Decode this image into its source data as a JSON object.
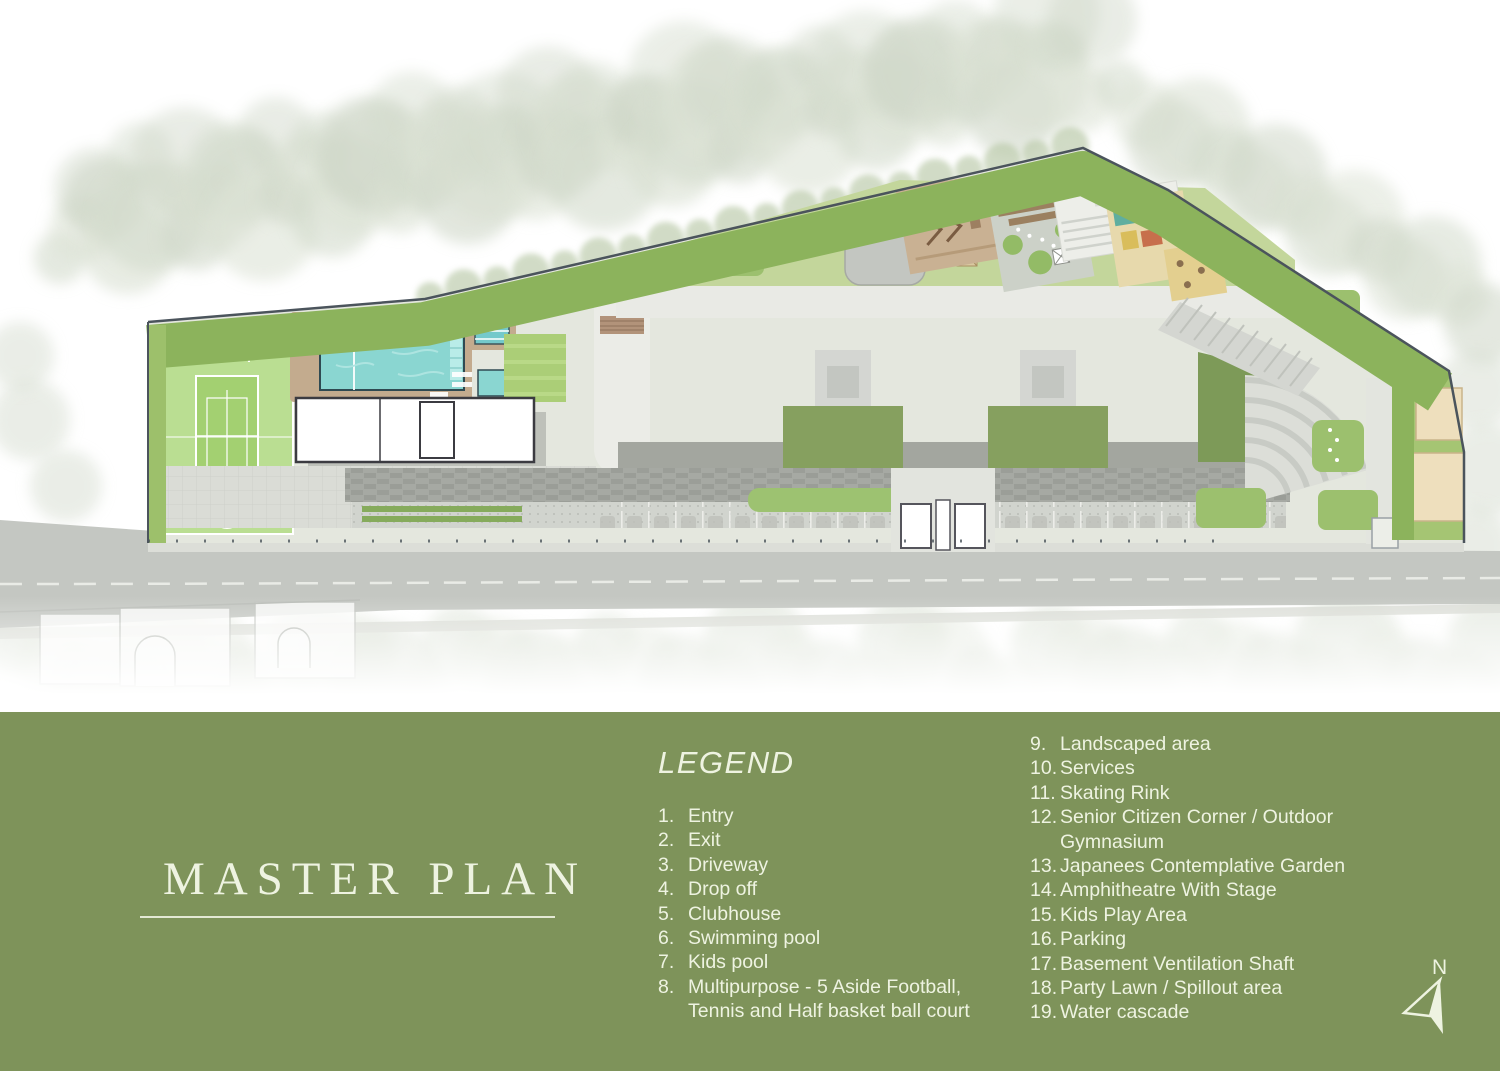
{
  "colors": {
    "band_bg": "#7E935A",
    "band_text": "#EEF3E1",
    "marker_red": "#8E1F2F",
    "tower_text": "#24242C",
    "tower_subtext": "#8B9096",
    "road_label_grey": "#C3C8C2",
    "pool_water": "#8AD6D1",
    "court_green": "#BADE92",
    "boundary_line": "#4B545C"
  },
  "plan": {
    "road_label": "ROAD",
    "towers": [
      {
        "name": "Tower - 01",
        "floors": "2B+G+17 Floors",
        "x": 741,
        "y": 352
      },
      {
        "name": "Tower - 02",
        "floors": "2B+G+11 Floors",
        "x": 946,
        "y": 352
      },
      {
        "name": "Tower - 03",
        "floors": "2B+G+17 Floors",
        "x": 1150,
        "y": 352
      }
    ],
    "markers": [
      {
        "label": "08",
        "x": 222,
        "y": 437
      },
      {
        "label": "07",
        "x": 338,
        "y": 361
      },
      {
        "label": "06",
        "x": 404,
        "y": 361
      },
      {
        "label": "19",
        "x": 493,
        "y": 329
      },
      {
        "label": "18",
        "x": 536,
        "y": 361
      },
      {
        "label": "17",
        "x": 578,
        "y": 361
      },
      {
        "label": "05",
        "x": 483,
        "y": 432
      },
      {
        "label": "09",
        "x": 738,
        "y": 256
      },
      {
        "label": "17",
        "x": 817,
        "y": 259
      },
      {
        "label": "11",
        "x": 882,
        "y": 252
      },
      {
        "label": "12",
        "x": 940,
        "y": 216
      },
      {
        "label": "13",
        "x": 1035,
        "y": 231
      },
      {
        "label": "14",
        "x": 1102,
        "y": 208
      },
      {
        "label": "15",
        "x": 1138,
        "y": 228
      },
      {
        "label": "17",
        "x": 1100,
        "y": 257
      },
      {
        "label": "09",
        "x": 1327,
        "y": 310
      },
      {
        "label": "09",
        "x": 1352,
        "y": 403
      },
      {
        "label": "10",
        "x": 1436,
        "y": 414
      },
      {
        "label": "10",
        "x": 1437,
        "y": 494
      },
      {
        "label": "04",
        "x": 742,
        "y": 484
      },
      {
        "label": "03",
        "x": 851,
        "y": 484
      },
      {
        "label": "04",
        "x": 947,
        "y": 484
      },
      {
        "label": "04",
        "x": 1147,
        "y": 483
      },
      {
        "label": "16",
        "x": 661,
        "y": 516
      },
      {
        "label": "16",
        "x": 1063,
        "y": 515
      },
      {
        "label": "09",
        "x": 1222,
        "y": 524
      },
      {
        "label": "09",
        "x": 1352,
        "y": 522
      },
      {
        "label": "01",
        "x": 918,
        "y": 551
      },
      {
        "label": "02",
        "x": 968,
        "y": 551
      },
      {
        "label": "02",
        "x": 1388,
        "y": 551
      }
    ]
  },
  "band": {
    "title": "MASTER PLAN",
    "legend_title": "LEGEND",
    "north_label": "N",
    "legend_left": [
      {
        "num": "1.",
        "lines": [
          "Entry"
        ]
      },
      {
        "num": "2.",
        "lines": [
          "Exit"
        ]
      },
      {
        "num": "3.",
        "lines": [
          "Driveway"
        ]
      },
      {
        "num": "4.",
        "lines": [
          "Drop off"
        ]
      },
      {
        "num": "5.",
        "lines": [
          "Clubhouse"
        ]
      },
      {
        "num": "6.",
        "lines": [
          "Swimming pool"
        ]
      },
      {
        "num": "7.",
        "lines": [
          "Kids pool"
        ]
      },
      {
        "num": "8.",
        "lines": [
          "Multipurpose - 5 Aside Football,",
          "Tennis and Half basket ball court"
        ]
      }
    ],
    "legend_right": [
      {
        "num": "9.",
        "lines": [
          "Landscaped area"
        ]
      },
      {
        "num": "10.",
        "lines": [
          "Services"
        ]
      },
      {
        "num": "11.",
        "lines": [
          "Skating Rink"
        ]
      },
      {
        "num": "12.",
        "lines": [
          "Senior Citizen Corner / Outdoor",
          "Gymnasium"
        ]
      },
      {
        "num": "13.",
        "lines": [
          "Japanees Contemplative Garden"
        ]
      },
      {
        "num": "14.",
        "lines": [
          "Amphitheatre With Stage"
        ]
      },
      {
        "num": "15.",
        "lines": [
          "Kids Play Area"
        ]
      },
      {
        "num": "16.",
        "lines": [
          "Parking"
        ]
      },
      {
        "num": "17.",
        "lines": [
          "Basement Ventilation Shaft"
        ]
      },
      {
        "num": "18.",
        "lines": [
          "Party Lawn / Spillout area"
        ]
      },
      {
        "num": "19.",
        "lines": [
          "Water cascade"
        ]
      }
    ]
  }
}
